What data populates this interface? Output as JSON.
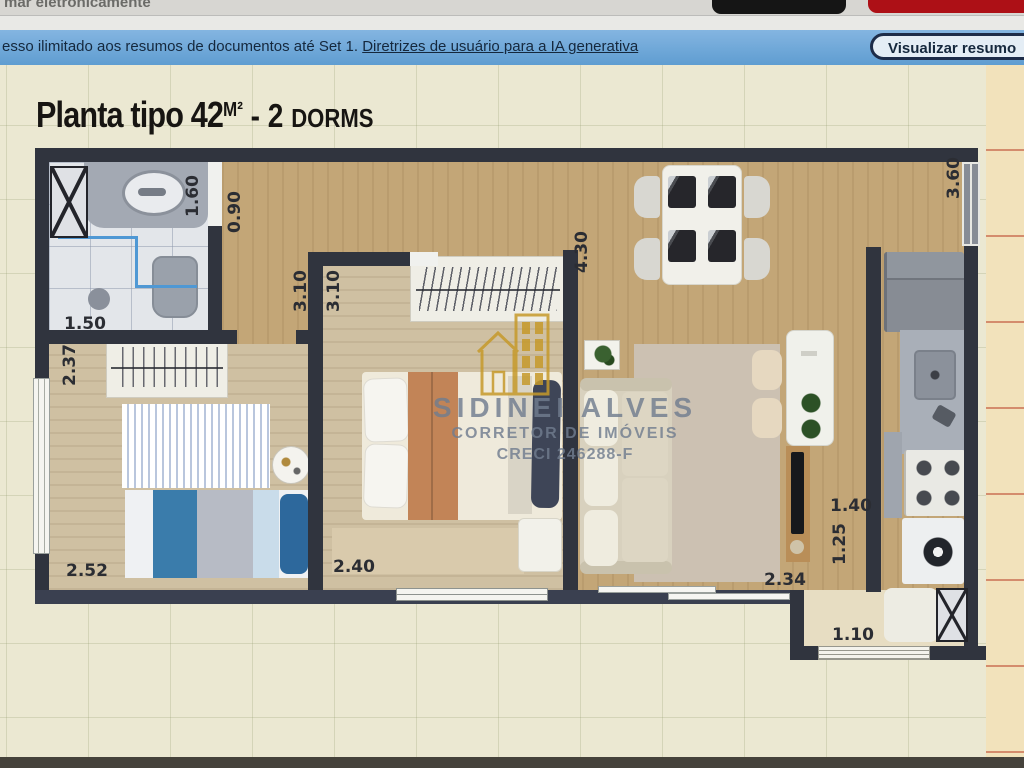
{
  "chrome": {
    "top_partial_text": "mar eletronicamente",
    "banner_text": "esso ilimitado aos resumos de documentos até Set 1.",
    "banner_link": "Diretrizes de usuário para a IA generativa",
    "button_label": "Visualizar resumo"
  },
  "plan": {
    "title": {
      "prefix": "Planta tipo 42",
      "unit": "M²",
      "middle": " - 2 ",
      "suffix": "DORMS"
    },
    "watermark": {
      "name": "SIDINEI ALVES",
      "role": "CORRETOR DE IMÓVEIS",
      "creci": "CRECI 246288-F"
    },
    "dims": {
      "bath_length": "1.60",
      "hall_width": "0.90",
      "bath_width": "1.50",
      "dorm2_depth": "2.37",
      "hall_length": "3.10",
      "dorm1_depth": "3.10",
      "dorm2_width": "2.52",
      "dorm1_width": "2.40",
      "living_length": "4.30",
      "kitchen_length": "3.60",
      "kitchen_pass": "1.40",
      "laundry_width": "1.25",
      "balcony_door": "2.34",
      "laundry_window": "1.10"
    },
    "colors": {
      "wall": "#30343E",
      "wood_floor": "#C3A677",
      "bedroom_floor": "#CFC0A2",
      "banner_blue": "#6FA8D8",
      "tab_red": "#AD1016",
      "watermark_gold": "#C69A2B",
      "watermark_gray": "#74808F"
    }
  }
}
